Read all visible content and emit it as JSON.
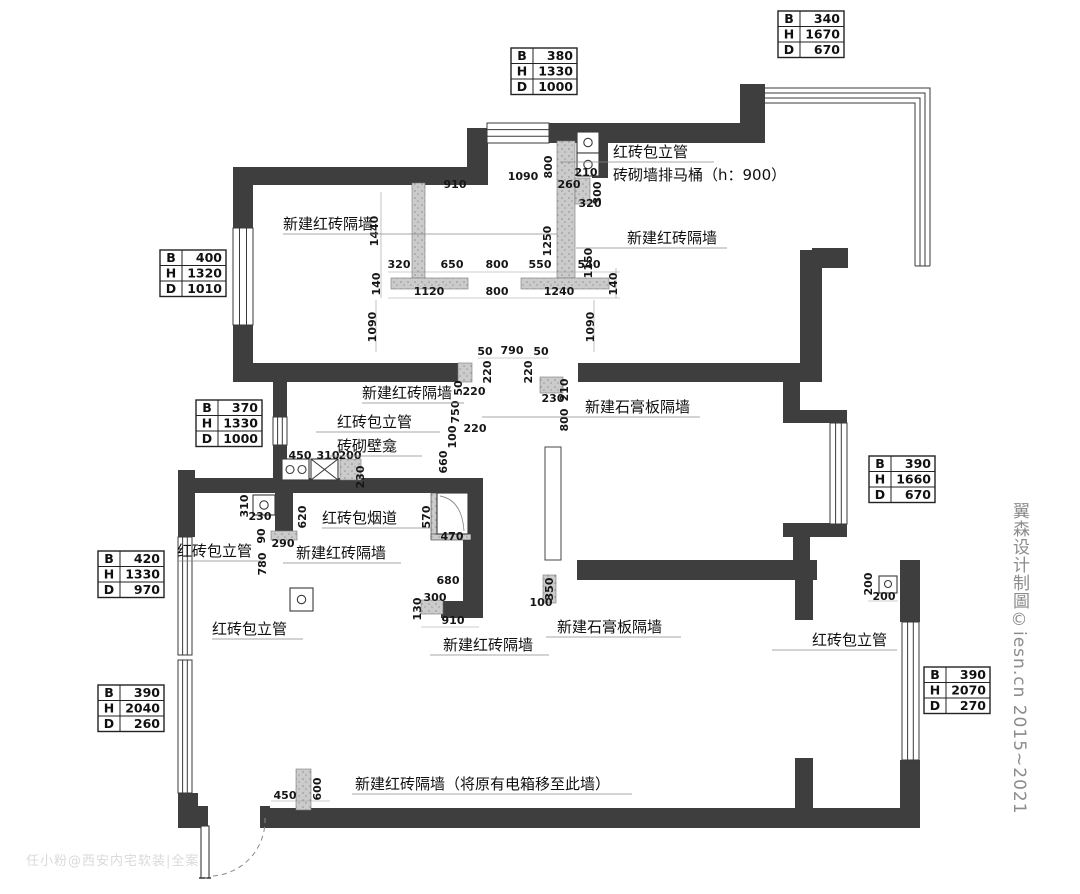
{
  "watermarks": {
    "right": "翼森设计制圖©iesn.cn 2015~2021",
    "bottom_left": "任小粉@西安内宅软装|全案"
  },
  "colors": {
    "existing_wall": "#3e3e3e",
    "new_brick_wall": "#cbcbcb",
    "line": "#3a3a3a",
    "text": "#111111",
    "watermark": "#8c8c8c"
  },
  "spec_tables": [
    {
      "x": 778,
      "y": 11,
      "rows": [
        {
          "k": "B",
          "v": "340"
        },
        {
          "k": "H",
          "v": "1670"
        },
        {
          "k": "D",
          "v": "670"
        }
      ]
    },
    {
      "x": 511,
      "y": 48,
      "rows": [
        {
          "k": "B",
          "v": "380"
        },
        {
          "k": "H",
          "v": "1330"
        },
        {
          "k": "D",
          "v": "1000"
        }
      ]
    },
    {
      "x": 160,
      "y": 250,
      "rows": [
        {
          "k": "B",
          "v": "400"
        },
        {
          "k": "H",
          "v": "1320"
        },
        {
          "k": "D",
          "v": "1010"
        }
      ]
    },
    {
      "x": 196,
      "y": 400,
      "rows": [
        {
          "k": "B",
          "v": "370"
        },
        {
          "k": "H",
          "v": "1330"
        },
        {
          "k": "D",
          "v": "1000"
        }
      ]
    },
    {
      "x": 98,
      "y": 551,
      "rows": [
        {
          "k": "B",
          "v": "420"
        },
        {
          "k": "H",
          "v": "1330"
        },
        {
          "k": "D",
          "v": "970"
        }
      ]
    },
    {
      "x": 869,
      "y": 456,
      "rows": [
        {
          "k": "B",
          "v": "390"
        },
        {
          "k": "H",
          "v": "1660"
        },
        {
          "k": "D",
          "v": "670"
        }
      ]
    },
    {
      "x": 98,
      "y": 685,
      "rows": [
        {
          "k": "B",
          "v": "390"
        },
        {
          "k": "H",
          "v": "2040"
        },
        {
          "k": "D",
          "v": "260"
        }
      ]
    },
    {
      "x": 924,
      "y": 667,
      "rows": [
        {
          "k": "B",
          "v": "390"
        },
        {
          "k": "H",
          "v": "2070"
        },
        {
          "k": "D",
          "v": "270"
        }
      ]
    }
  ],
  "wall_labels": [
    {
      "t": "红砖包立管",
      "x": 613,
      "y": 157,
      "u": [
        560,
        714
      ]
    },
    {
      "t": "砖砌墙排马桶（h：900）",
      "x": 613,
      "y": 180
    },
    {
      "t": "新建红砖隔墙",
      "x": 283,
      "y": 229,
      "u": [
        283,
        557
      ]
    },
    {
      "t": "新建红砖隔墙",
      "x": 627,
      "y": 243,
      "u": [
        576,
        727
      ]
    },
    {
      "t": "新建红砖隔墙",
      "x": 362,
      "y": 398,
      "u": [
        362,
        464
      ]
    },
    {
      "t": "红砖包立管",
      "x": 337,
      "y": 427,
      "u": [
        316,
        440
      ]
    },
    {
      "t": "砖砌壁龛",
      "x": 337,
      "y": 451,
      "u": [
        330,
        422
      ]
    },
    {
      "t": "新建石膏板隔墙",
      "x": 585,
      "y": 412,
      "u": [
        482,
        700
      ]
    },
    {
      "t": "红砖包烟道",
      "x": 322,
      "y": 523,
      "u": [
        322,
        431
      ]
    },
    {
      "t": "红砖包立管",
      "x": 177,
      "y": 556,
      "u": [
        177,
        262
      ]
    },
    {
      "t": "新建红砖隔墙",
      "x": 296,
      "y": 558,
      "u": [
        283,
        401
      ]
    },
    {
      "t": "红砖包立管",
      "x": 212,
      "y": 634,
      "u": [
        212,
        303
      ]
    },
    {
      "t": "新建红砖隔墙",
      "x": 443,
      "y": 650,
      "u": [
        430,
        549
      ]
    },
    {
      "t": "新建石膏板隔墙",
      "x": 557,
      "y": 632,
      "u": [
        546,
        681
      ]
    },
    {
      "t": "红砖包立管",
      "x": 812,
      "y": 645,
      "u": [
        772,
        897
      ]
    },
    {
      "t": "新建红砖隔墙（将原有电箱移至此墙）",
      "x": 355,
      "y": 789,
      "u": [
        352,
        632
      ]
    }
  ],
  "dimensions": [
    {
      "t": "910",
      "x": 455,
      "y": 188
    },
    {
      "t": "1090",
      "x": 523,
      "y": 180
    },
    {
      "t": "800",
      "x": 552,
      "y": 167,
      "v": 1
    },
    {
      "t": "210",
      "x": 586,
      "y": 176
    },
    {
      "t": "260",
      "x": 569,
      "y": 188
    },
    {
      "t": "300",
      "x": 601,
      "y": 193,
      "v": 1
    },
    {
      "t": "320",
      "x": 590,
      "y": 207
    },
    {
      "t": "1440",
      "x": 378,
      "y": 231,
      "v": 1
    },
    {
      "t": "1250",
      "x": 551,
      "y": 241,
      "v": 1
    },
    {
      "t": "1150",
      "x": 592,
      "y": 263,
      "v": 1
    },
    {
      "t": "320",
      "x": 399,
      "y": 268
    },
    {
      "t": "650",
      "x": 452,
      "y": 268
    },
    {
      "t": "800",
      "x": 497,
      "y": 268
    },
    {
      "t": "550",
      "x": 540,
      "y": 268
    },
    {
      "t": "540",
      "x": 589,
      "y": 268
    },
    {
      "t": "140",
      "x": 380,
      "y": 284,
      "v": 1
    },
    {
      "t": "140",
      "x": 617,
      "y": 284,
      "v": 1
    },
    {
      "t": "1120",
      "x": 429,
      "y": 295
    },
    {
      "t": "800",
      "x": 497,
      "y": 295
    },
    {
      "t": "1240",
      "x": 559,
      "y": 295
    },
    {
      "t": "1090",
      "x": 376,
      "y": 327,
      "v": 1
    },
    {
      "t": "1090",
      "x": 594,
      "y": 327,
      "v": 1
    },
    {
      "t": "50",
      "x": 485,
      "y": 355
    },
    {
      "t": "790",
      "x": 512,
      "y": 354
    },
    {
      "t": "50",
      "x": 541,
      "y": 355
    },
    {
      "t": "220",
      "x": 491,
      "y": 372,
      "v": 1
    },
    {
      "t": "220",
      "x": 532,
      "y": 372,
      "v": 1
    },
    {
      "t": "50",
      "x": 462,
      "y": 388,
      "v": 1
    },
    {
      "t": "220",
      "x": 474,
      "y": 395
    },
    {
      "t": "750",
      "x": 459,
      "y": 412,
      "v": 1
    },
    {
      "t": "230",
      "x": 553,
      "y": 402
    },
    {
      "t": "210",
      "x": 568,
      "y": 390,
      "v": 1
    },
    {
      "t": "800",
      "x": 568,
      "y": 420,
      "v": 1
    },
    {
      "t": "100",
      "x": 456,
      "y": 437,
      "v": 1
    },
    {
      "t": "220",
      "x": 475,
      "y": 432
    },
    {
      "t": "660",
      "x": 447,
      "y": 462,
      "v": 1
    },
    {
      "t": "450",
      "x": 300,
      "y": 459
    },
    {
      "t": "310",
      "x": 328,
      "y": 459
    },
    {
      "t": "200",
      "x": 350,
      "y": 459
    },
    {
      "t": "230",
      "x": 364,
      "y": 477,
      "v": 1
    },
    {
      "t": "310",
      "x": 248,
      "y": 506,
      "v": 1
    },
    {
      "t": "230",
      "x": 260,
      "y": 520
    },
    {
      "t": "90",
      "x": 265,
      "y": 536,
      "v": 1
    },
    {
      "t": "290",
      "x": 283,
      "y": 547
    },
    {
      "t": "620",
      "x": 306,
      "y": 517,
      "v": 1
    },
    {
      "t": "780",
      "x": 266,
      "y": 564,
      "v": 1
    },
    {
      "t": "570",
      "x": 430,
      "y": 517,
      "v": 1
    },
    {
      "t": "470",
      "x": 452,
      "y": 540
    },
    {
      "t": "680",
      "x": 448,
      "y": 584
    },
    {
      "t": "300",
      "x": 435,
      "y": 601
    },
    {
      "t": "130",
      "x": 421,
      "y": 609,
      "v": 1
    },
    {
      "t": "910",
      "x": 453,
      "y": 624
    },
    {
      "t": "350",
      "x": 553,
      "y": 589,
      "v": 1
    },
    {
      "t": "100",
      "x": 541,
      "y": 606
    },
    {
      "t": "200",
      "x": 872,
      "y": 584,
      "v": 1
    },
    {
      "t": "200",
      "x": 884,
      "y": 600
    },
    {
      "t": "450",
      "x": 285,
      "y": 799
    },
    {
      "t": "600",
      "x": 321,
      "y": 789,
      "v": 1
    }
  ]
}
